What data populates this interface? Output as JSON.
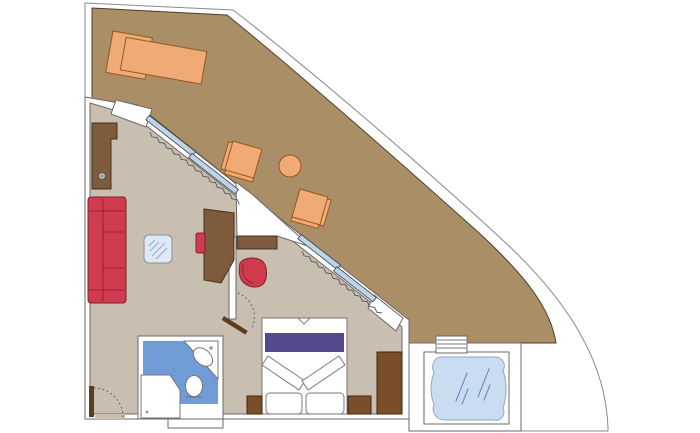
{
  "plan": {
    "kind": "cruise-suite-floor-plan",
    "rooms": [
      {
        "id": "balcony-terrace"
      },
      {
        "id": "living-area"
      },
      {
        "id": "bedroom"
      },
      {
        "id": "bathroom"
      },
      {
        "id": "whirlpool-deck"
      }
    ],
    "furniture": [
      "sun-lounger",
      "balcony-chair-upper",
      "balcony-round-table",
      "balcony-chair-lower",
      "wardrobe",
      "sofa",
      "glass-coffee-table",
      "desk",
      "desk-stool",
      "armchair",
      "wall-console",
      "double-bed",
      "bed-runner",
      "pillow-left",
      "pillow-right",
      "nightstand-left",
      "nightstand-right",
      "bedroom-wardrobe",
      "washbasin-counter",
      "washbasin",
      "toilet",
      "shower",
      "whirlpool-tub",
      "whirlpool-steps",
      "entrance-door",
      "bathroom-door",
      "sliding-glass-door-1",
      "sliding-glass-door-2",
      "curtain-1",
      "curtain-2"
    ]
  },
  "palette": {
    "outline": "#8a8a8a",
    "wall": "#ffffff",
    "wallStroke": "#6a6a6a",
    "balcony": "#a98e66",
    "balconyStroke": "#4f3d29",
    "floor": "#c9bfb1",
    "orange": "#efaa76",
    "orangeStroke": "#96581f",
    "red": "#d13b50",
    "redStroke": "#7e1f2b",
    "brown": "#7d5b3c",
    "brownStroke": "#46311c",
    "darkBrown": "#7a4e28",
    "darkBrownStroke": "#3f270e",
    "doorLeaf": "#5c3d20",
    "purple": "#524a8c",
    "bathBlue": "#6f9bd7",
    "water": "#c9dcf1",
    "waterStroke": "#8fa9c4",
    "sparkle": "#6d89b8",
    "glassDoor": "#bdd3ea",
    "glassStroke": "#3f3f3f",
    "tableGlass": "#dfe9f5",
    "tableLine": "#88a6cf",
    "fixtureStroke": "#777777",
    "curtain": "#555555"
  }
}
